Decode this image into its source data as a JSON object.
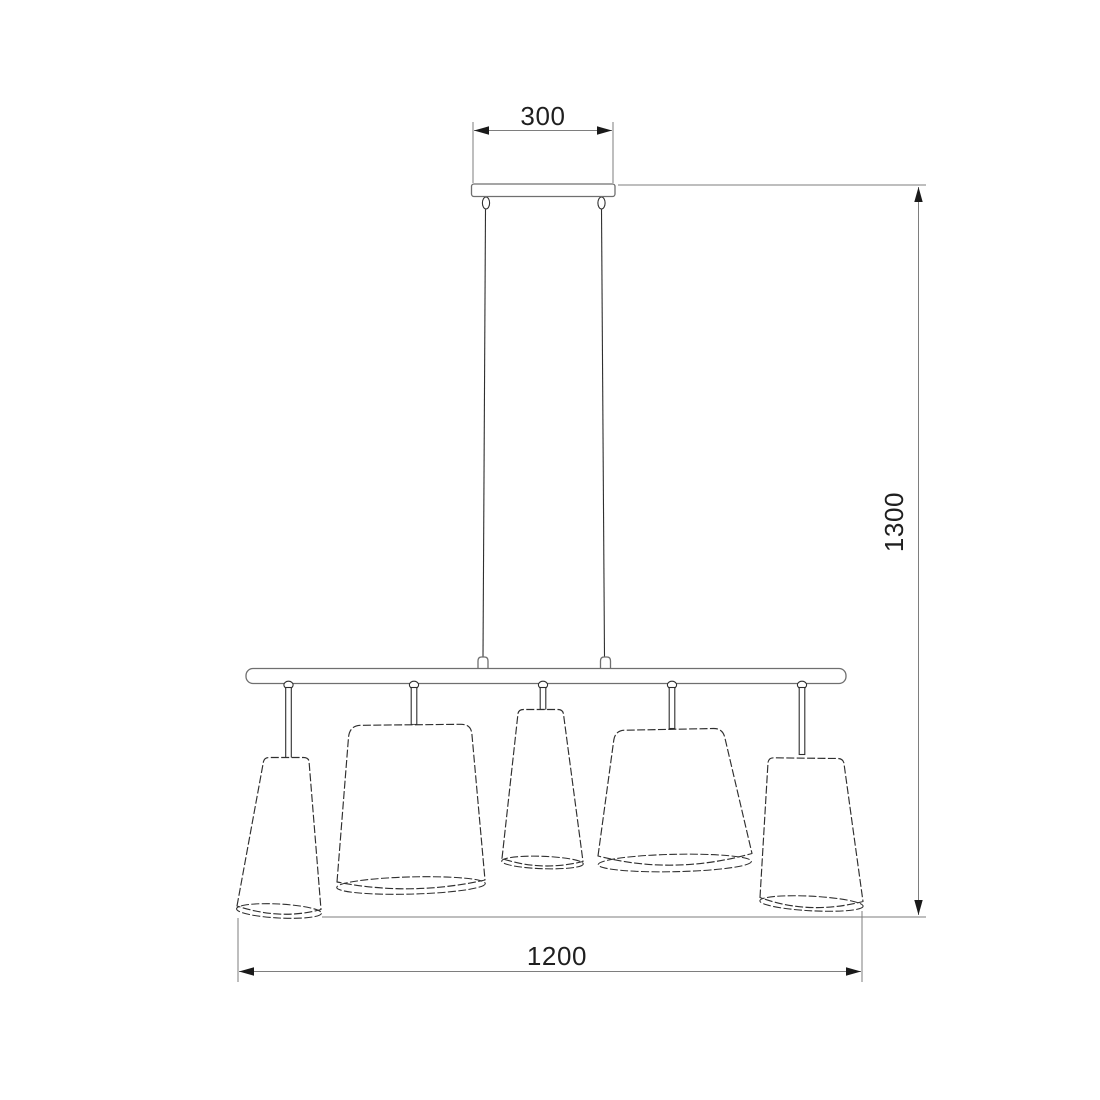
{
  "page": {
    "background": "#ffffff"
  },
  "drawing": {
    "kind": "dimensioned technical line drawing",
    "subject": "linear pendant chandelier with five tapered shades",
    "shade_count": 5,
    "suspension_cord_count": 2
  },
  "dimensions": {
    "canopy_width": {
      "value": "300",
      "orientation": "horizontal",
      "position": "top"
    },
    "overall_drop": {
      "value": "1300",
      "orientation": "vertical",
      "position": "right"
    },
    "fixture_length": {
      "value": "1200",
      "orientation": "horizontal",
      "position": "bottom"
    }
  },
  "theme": {
    "background": "#ffffff",
    "outline": "#2f2f2f",
    "hardware": "#6f6f6f",
    "dimline": "#7e7e7e",
    "arrow": "#1a1a1a",
    "text": "#1f1f1f"
  }
}
